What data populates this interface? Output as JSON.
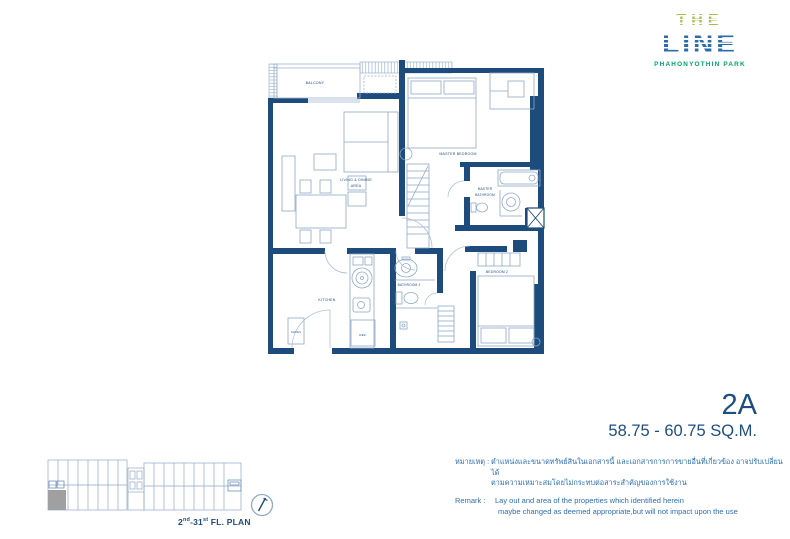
{
  "logo": {
    "the": "THE",
    "line": "LINE",
    "subtitle": "PHAHONYOTHIN PARK"
  },
  "unit": {
    "code": "2A",
    "area_range": "58.75 - 60.75 SQ.M."
  },
  "plan": {
    "rooms": {
      "balcony": "BALCONY",
      "master_bedroom": "MASTER BEDROOM",
      "living_dining_1": "LIVING & DINING",
      "living_dining_2": "AREA",
      "master_bath_1": "MASTER",
      "master_bath_2": "BATHROOM",
      "kitchen": "KITCHEN",
      "bathroom2": "BATHROOM 2",
      "bedroom2": "BEDROOM 2",
      "shoes": "SHOES",
      "ref": "REF."
    }
  },
  "key_plan": {
    "floor_prefix": "2",
    "floor_sup1": "nd",
    "floor_mid": "-31",
    "floor_sup2": "st",
    "floor_suffix": " FL. PLAN"
  },
  "remarks": {
    "th_label": "หมายเหตุ :",
    "th_line1": "ตำแหน่งและขนาดทรัพย์สินในเอกสารนี้ และเอกสารการการขายอื่นที่เกี่ยวข้อง อาจปรับเปลี่ยนได้",
    "th_line2": "ตามความเหมาะสมโดยไม่กระทบต่อสาระสำคัญของการใช้งาน",
    "en_label": "Remark :",
    "en_line1": "Lay out and area of the properties which identified herein",
    "en_line2": "maybe changed as deemed appropriate,but will not impact upon the use"
  },
  "colors": {
    "wall_navy": "#1c4b7c",
    "plan_line_blue": "#8ea9c9",
    "logo_green": "#a3c152",
    "logo_blue": "#2d6cab",
    "logo_teal_green": "#00a36a",
    "remark_blue": "#2f6eb0",
    "highlight_gray": "#a0a0a0"
  }
}
